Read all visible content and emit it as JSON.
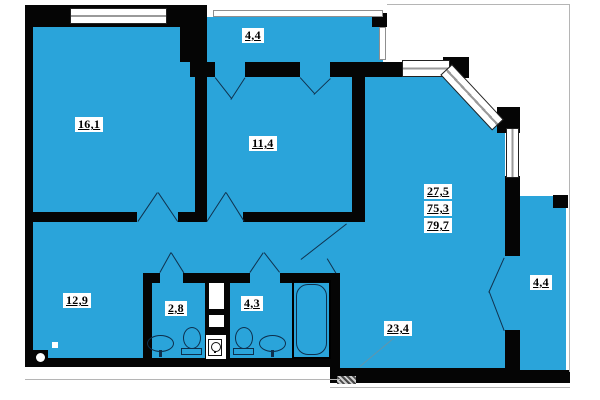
{
  "title": "apartment-floor-plan",
  "colors": {
    "room_fill": "#2aa4da",
    "wall": "#050505",
    "label_bg": "#ffffff",
    "label_text": "#000000"
  },
  "rooms": [
    {
      "name": "bedroom-1",
      "area": "16,1"
    },
    {
      "name": "balcony-top",
      "area": "4,4"
    },
    {
      "name": "bedroom-2",
      "area": "11,4"
    },
    {
      "name": "hallway",
      "area": "12,9"
    },
    {
      "name": "wc",
      "area": "2,8"
    },
    {
      "name": "bathroom",
      "area": "4,3"
    },
    {
      "name": "living-room",
      "area": "23,4"
    },
    {
      "name": "balcony-right",
      "area": "4,4"
    }
  ],
  "area_summary": {
    "living": "27,5",
    "total": "75,3",
    "total_with_balconies": "79,7"
  }
}
